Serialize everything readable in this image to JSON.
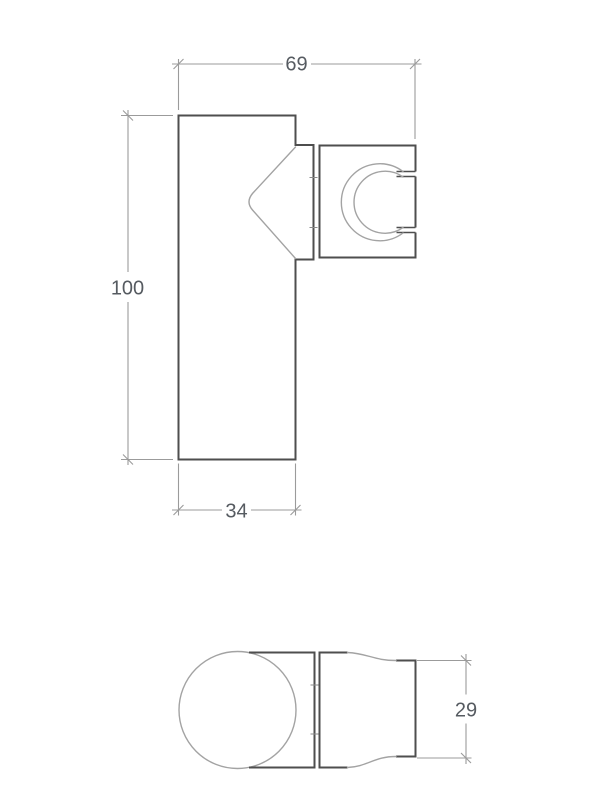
{
  "drawing": {
    "kind": "technical-dimension-drawing",
    "background_color": "#ffffff",
    "views": {
      "side_view": {
        "description": "side elevation of wall-mounted hand shower holder",
        "dimensions": {
          "overall_width": {
            "value": "69"
          },
          "overall_height": {
            "value": "100"
          },
          "base_depth": {
            "value": "34"
          }
        }
      },
      "bottom_view": {
        "description": "bottom view with round knob, mounting block and holder clip",
        "dimensions": {
          "holder_width": {
            "value": "29"
          }
        }
      }
    }
  },
  "colors": {
    "outline": "#4e4e4e",
    "curve": "#a3a3a3",
    "dimension": "#9b9b9b",
    "joint": "#8a8a8a",
    "text": "#565b61",
    "background": "#ffffff"
  }
}
